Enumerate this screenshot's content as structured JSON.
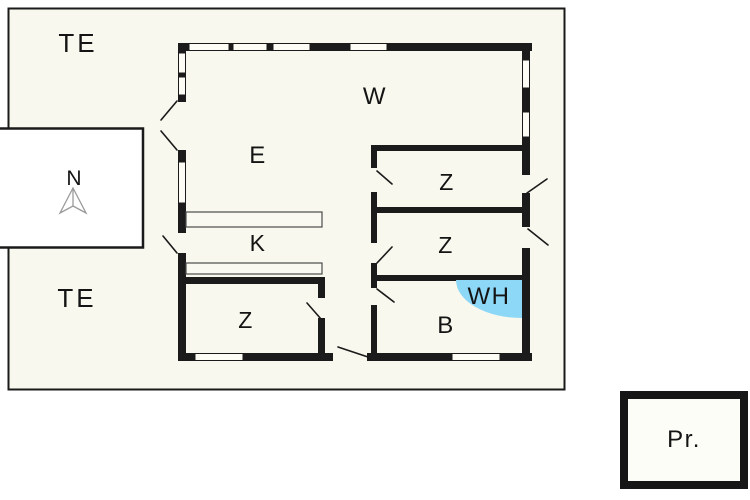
{
  "labels": {
    "terrace_top": "TE",
    "terrace_bottom": "TE",
    "compass_north": "N",
    "living_room": "W",
    "dining_area": "E",
    "kitchen": "K",
    "bedroom_right_top": "Z",
    "bedroom_right_middle": "Z",
    "bedroom_left": "Z",
    "bathroom": "B",
    "water_heater": "WH",
    "outbuilding": "Pr."
  },
  "colors": {
    "page_background": "#ffffff",
    "plan_background": "#f8f8ee",
    "wall": "#1b1b1b",
    "water_heater_fill": "#8dd7f7",
    "compass_stroke": "#9a9a9a",
    "outbuilding_fill": "#fdfdf8"
  }
}
